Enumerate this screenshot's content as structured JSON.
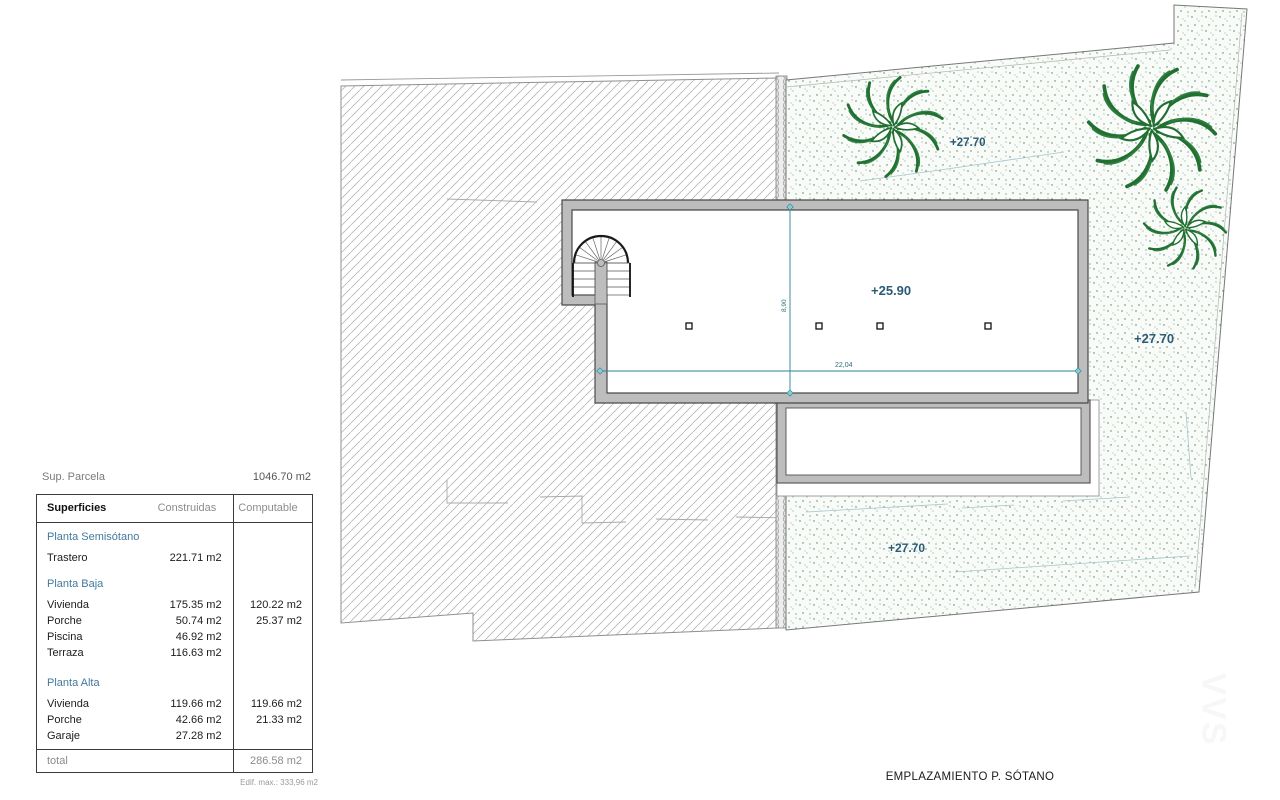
{
  "parcel": {
    "sup_label": "Sup. Parcela",
    "sup_value": "1046.70 m2"
  },
  "table": {
    "headers": {
      "col1": "Superficies",
      "col2": "Construidas",
      "col3": "Computable"
    },
    "sections": [
      {
        "name": "Planta Semisótano",
        "rows": [
          {
            "label": "Trastero",
            "construida": "221.71 m2",
            "computable": ""
          }
        ]
      },
      {
        "name": "Planta Baja",
        "rows": [
          {
            "label": "Vivienda",
            "construida": "175.35 m2",
            "computable": "120.22 m2"
          },
          {
            "label": "Porche",
            "construida": "50.74 m2",
            "computable": "25.37 m2"
          },
          {
            "label": "Piscina",
            "construida": "46.92 m2",
            "computable": ""
          },
          {
            "label": "Terraza",
            "construida": "116.63 m2",
            "computable": ""
          }
        ]
      },
      {
        "name": "Planta Alta",
        "rows": [
          {
            "label": "Vivienda",
            "construida": "119.66 m2",
            "computable": "119.66 m2"
          },
          {
            "label": "Porche",
            "construida": "42.66 m2",
            "computable": "21.33 m2"
          },
          {
            "label": "Garaje",
            "construida": "27.28 m2",
            "computable": ""
          }
        ]
      }
    ],
    "total_label": "total",
    "total_value": "286.58 m2",
    "footnote": "Edif. max.: 333,96 m2"
  },
  "plan": {
    "caption": "EMPLAZAMIENTO P. SÓTANO",
    "elevations": {
      "building": "+25.90",
      "garden_top": "+27.70",
      "garden_right": "+27.70",
      "garden_bottom": "+27.70"
    },
    "dimensions": {
      "width": "22,04",
      "height": "8,90"
    },
    "watermark": "VVS",
    "colors": {
      "dimension_line": "#2e8391",
      "elevation_text": "#2b5b75",
      "tree_green": "#217031",
      "wall_gray": "#bdbdbd",
      "section_header_blue": "#44789e"
    }
  }
}
